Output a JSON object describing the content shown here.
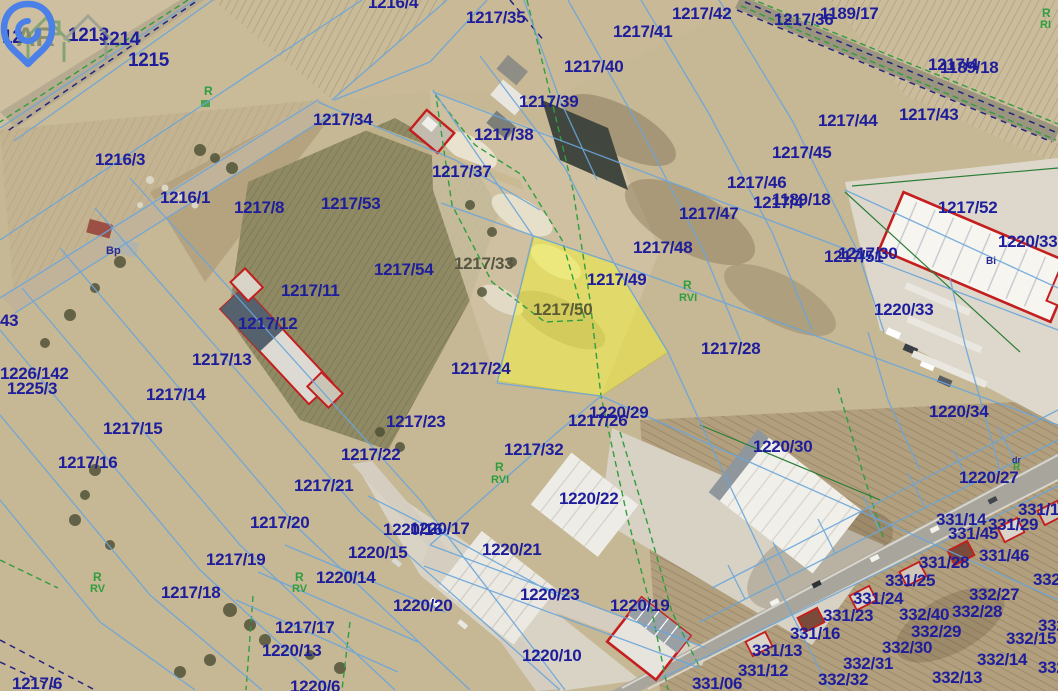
{
  "map": {
    "highlighted_parcel": "1217/50",
    "watermark_text": "AR",
    "colors": {
      "parcel_label": "#1e1e9c",
      "soil_label": "#2f9e3f",
      "highlight_fill": "#eeea3c",
      "parcel_line_blue": "#69a5da",
      "landuse_line_green": "#2f9e3f",
      "building_outline_red": "#c41e1e",
      "logo_blue": "#4b80e8"
    },
    "parcel_labels": [
      {
        "t": "12",
        "x": 2,
        "y": 27,
        "fs": 19
      },
      {
        "t": "1213",
        "x": 68,
        "y": 25,
        "fs": 19
      },
      {
        "t": "1214",
        "x": 99,
        "y": 29,
        "fs": 19
      },
      {
        "t": "1215",
        "x": 128,
        "y": 50,
        "fs": 19
      },
      {
        "t": "1216/4",
        "x": 368,
        "y": -7
      },
      {
        "t": "1216/3",
        "x": 95,
        "y": 150
      },
      {
        "t": "1216/1",
        "x": 160,
        "y": 188
      },
      {
        "t": "1217/8",
        "x": 234,
        "y": 198
      },
      {
        "t": "1217/34",
        "x": 313,
        "y": 110
      },
      {
        "t": "1217/35",
        "x": 466,
        "y": 8
      },
      {
        "t": "1217/38",
        "x": 474,
        "y": 125
      },
      {
        "t": "1217/37",
        "x": 432,
        "y": 162
      },
      {
        "t": "1217/53",
        "x": 321,
        "y": 194
      },
      {
        "t": "1217/54",
        "x": 374,
        "y": 260
      },
      {
        "t": "1217/33",
        "x": 454,
        "y": 254,
        "c": "#565642"
      },
      {
        "t": "1217/11",
        "x": 281,
        "y": 281
      },
      {
        "t": "1217/12",
        "x": 238,
        "y": 314
      },
      {
        "t": "1217/13",
        "x": 192,
        "y": 350
      },
      {
        "t": "1217/14",
        "x": 146,
        "y": 385
      },
      {
        "t": "1217/15",
        "x": 103,
        "y": 419
      },
      {
        "t": "1217/16",
        "x": 58,
        "y": 453
      },
      {
        "t": "43",
        "x": 0,
        "y": 311
      },
      {
        "t": "1226/142",
        "x": 0,
        "y": 364
      },
      {
        "t": "1225/3",
        "x": 7,
        "y": 379
      },
      {
        "t": "1217/42",
        "x": 672,
        "y": 4
      },
      {
        "t": "1217/41",
        "x": 613,
        "y": 22
      },
      {
        "t": "1217/40",
        "x": 564,
        "y": 57
      },
      {
        "t": "1217/39",
        "x": 519,
        "y": 92
      },
      {
        "t": "1217/36",
        "x": 774,
        "y": 10
      },
      {
        "t": "1189/17",
        "x": 820,
        "y": 4
      },
      {
        "t": "1217/4",
        "x": 928,
        "y": 55
      },
      {
        "t": "1189/18",
        "x": 940,
        "y": 58
      },
      {
        "t": "1217/4",
        "x": 753,
        "y": 193
      },
      {
        "t": "1189/18",
        "x": 772,
        "y": 190
      },
      {
        "t": "1217/44",
        "x": 818,
        "y": 111
      },
      {
        "t": "1217/43",
        "x": 899,
        "y": 105
      },
      {
        "t": "1217/45",
        "x": 772,
        "y": 143
      },
      {
        "t": "1217/46",
        "x": 727,
        "y": 173
      },
      {
        "t": "1217/47",
        "x": 679,
        "y": 204
      },
      {
        "t": "1217/48",
        "x": 633,
        "y": 238
      },
      {
        "t": "1217/49",
        "x": 587,
        "y": 270
      },
      {
        "t": "1217/50",
        "x": 533,
        "y": 300,
        "c": "#5c5c34"
      },
      {
        "t": "1217/28",
        "x": 701,
        "y": 339
      },
      {
        "t": "1217/52",
        "x": 938,
        "y": 198
      },
      {
        "t": "1220/33",
        "x": 998,
        "y": 232
      },
      {
        "t": "1217/51",
        "x": 824,
        "y": 247
      },
      {
        "t": "1217/30",
        "x": 838,
        "y": 244
      },
      {
        "t": "1220/33",
        "x": 874,
        "y": 300
      },
      {
        "t": "1220/34",
        "x": 929,
        "y": 402
      },
      {
        "t": "1220/27",
        "x": 959,
        "y": 468
      },
      {
        "t": "1220/30",
        "x": 753,
        "y": 437
      },
      {
        "t": "1217/24",
        "x": 451,
        "y": 359
      },
      {
        "t": "1217/23",
        "x": 386,
        "y": 412
      },
      {
        "t": "1217/22",
        "x": 341,
        "y": 445
      },
      {
        "t": "1217/21",
        "x": 294,
        "y": 476
      },
      {
        "t": "1217/20",
        "x": 250,
        "y": 513
      },
      {
        "t": "1217/19",
        "x": 206,
        "y": 550
      },
      {
        "t": "1217/18",
        "x": 161,
        "y": 583
      },
      {
        "t": "1217/17",
        "x": 275,
        "y": 618
      },
      {
        "t": "1217/32",
        "x": 504,
        "y": 440
      },
      {
        "t": "1217/26",
        "x": 568,
        "y": 411
      },
      {
        "t": "1220/29",
        "x": 589,
        "y": 403
      },
      {
        "t": "1220/22",
        "x": 559,
        "y": 489
      },
      {
        "t": "1220/16",
        "x": 383,
        "y": 520
      },
      {
        "t": "1220/17",
        "x": 410,
        "y": 519
      },
      {
        "t": "1220/15",
        "x": 348,
        "y": 543
      },
      {
        "t": "1220/14",
        "x": 316,
        "y": 568
      },
      {
        "t": "1220/21",
        "x": 482,
        "y": 540
      },
      {
        "t": "1220/20",
        "x": 393,
        "y": 596
      },
      {
        "t": "1220/13",
        "x": 262,
        "y": 641
      },
      {
        "t": "1220/6",
        "x": 290,
        "y": 677
      },
      {
        "t": "1217/6",
        "x": 12,
        "y": 674
      },
      {
        "t": "1220/23",
        "x": 520,
        "y": 585
      },
      {
        "t": "1220/19",
        "x": 610,
        "y": 596
      },
      {
        "t": "1220/10",
        "x": 522,
        "y": 646
      },
      {
        "t": "331/16",
        "x": 790,
        "y": 624
      },
      {
        "t": "331/13",
        "x": 752,
        "y": 641
      },
      {
        "t": "331/12",
        "x": 738,
        "y": 661
      },
      {
        "t": "331/06",
        "x": 692,
        "y": 674
      },
      {
        "t": "331/23",
        "x": 823,
        "y": 606
      },
      {
        "t": "331/24",
        "x": 853,
        "y": 589
      },
      {
        "t": "331/25",
        "x": 885,
        "y": 571
      },
      {
        "t": "331/28",
        "x": 919,
        "y": 553
      },
      {
        "t": "331/46",
        "x": 979,
        "y": 546
      },
      {
        "t": "331/45",
        "x": 948,
        "y": 524
      },
      {
        "t": "331/14",
        "x": 936,
        "y": 510
      },
      {
        "t": "331/29",
        "x": 988,
        "y": 515
      },
      {
        "t": "331/15",
        "x": 1018,
        "y": 500
      },
      {
        "t": "332/40",
        "x": 899,
        "y": 605
      },
      {
        "t": "332/27",
        "x": 969,
        "y": 585
      },
      {
        "t": "332/26",
        "x": 1033,
        "y": 570
      },
      {
        "t": "332/28",
        "x": 952,
        "y": 602
      },
      {
        "t": "332/29",
        "x": 911,
        "y": 622
      },
      {
        "t": "332/30",
        "x": 882,
        "y": 638
      },
      {
        "t": "332/31",
        "x": 843,
        "y": 654
      },
      {
        "t": "332/32",
        "x": 818,
        "y": 670
      },
      {
        "t": "332/13",
        "x": 932,
        "y": 668
      },
      {
        "t": "332/14",
        "x": 977,
        "y": 650
      },
      {
        "t": "332/15",
        "x": 1006,
        "y": 629
      },
      {
        "t": "332/7",
        "x": 1038,
        "y": 658
      },
      {
        "t": "332",
        "x": 1038,
        "y": 616
      }
    ],
    "soil_labels": [
      {
        "t": "R",
        "x": 204,
        "y": 84,
        "fs": 12
      },
      {
        "t": "R",
        "x": 93,
        "y": 570,
        "fs": 12
      },
      {
        "t": "RV",
        "x": 90,
        "y": 583
      },
      {
        "t": "R",
        "x": 295,
        "y": 570,
        "fs": 12
      },
      {
        "t": "RV",
        "x": 292,
        "y": 583
      },
      {
        "t": "R",
        "x": 495,
        "y": 460,
        "fs": 12
      },
      {
        "t": "RVI",
        "x": 491,
        "y": 474
      },
      {
        "t": "R",
        "x": 683,
        "y": 278,
        "fs": 12
      },
      {
        "t": "RVI",
        "x": 679,
        "y": 292
      },
      {
        "t": "R",
        "x": 1042,
        "y": 6,
        "fs": 12
      },
      {
        "t": "RI",
        "x": 1040,
        "y": 19
      },
      {
        "t": "R",
        "x": 1013,
        "y": 462,
        "fs": 10
      }
    ],
    "landuse_labels": [
      {
        "t": "Bp",
        "x": 106,
        "y": 245
      },
      {
        "t": "Bi",
        "x": 986,
        "y": 256,
        "fs": 10
      },
      {
        "t": "dr",
        "x": 1012,
        "y": 455,
        "fs": 9
      }
    ]
  }
}
